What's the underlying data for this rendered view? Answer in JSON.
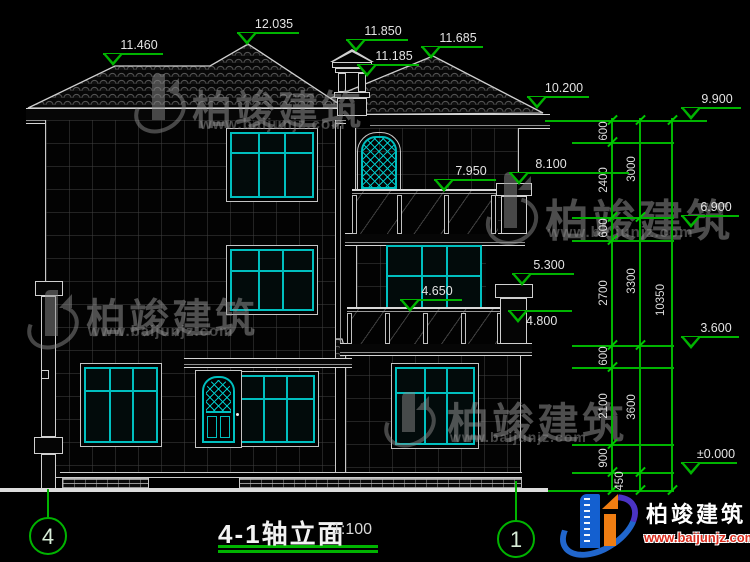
{
  "drawing": {
    "title": "4-1轴立面",
    "scale": "1:100"
  },
  "axes": {
    "left": "4",
    "right": "1"
  },
  "marks": {
    "m11460": "11.460",
    "m12035": "12.035",
    "m11850": "11.850",
    "m11185": "11.185",
    "m11685": "11.685",
    "m10200": "10.200",
    "m9900": "9.900",
    "m8100": "8.100",
    "m7950": "7.950",
    "m6900": "6.900",
    "m5300": "5.300",
    "m4650": "4.650",
    "m4800": "4.800",
    "m3600": "3.600",
    "m0000": "±0.000"
  },
  "dims": {
    "floor_chain": [
      "600",
      "2400",
      "600",
      "2700",
      "600",
      "2100",
      "900",
      "450"
    ],
    "story_chain": [
      "3000",
      "3300",
      "3600"
    ],
    "total_height": "10350"
  },
  "watermark": {
    "brand": "柏竣建筑",
    "site": "www.baijunjz.com"
  },
  "logo": {
    "brand": "柏竣建筑",
    "site": "www.baijunjz.com"
  }
}
